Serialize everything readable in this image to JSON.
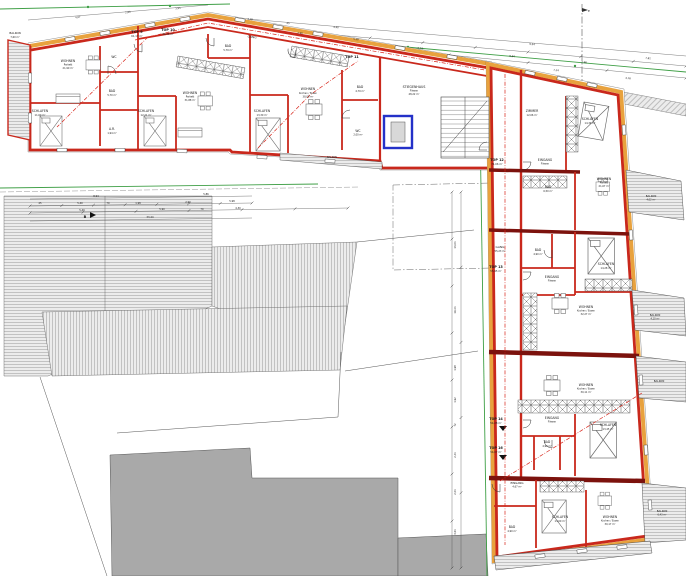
{
  "colors": {
    "wall_red": "#c9281c",
    "wall_dark": "#7c120d",
    "insulation_orange": "#e8a23e",
    "elevator_blue": "#2431c8",
    "boundary_green": "#3f9f46",
    "escape_red": "#d8251a",
    "roof_fill": "#ececec",
    "hatch_line": "#8f8f8f",
    "terrain_gray": "#a9a9a9",
    "drawing_line": "#2b2b2b"
  },
  "labels": {
    "units": [
      {
        "n": "unit-top9",
        "t": "TOP 9",
        "x": 137,
        "y": 33,
        "s": 3.4,
        "b": 1
      },
      {
        "n": "unit-top9-area",
        "t": "61,17 m²",
        "x": 137,
        "y": 37,
        "s": 2.5
      },
      {
        "n": "unit-top10",
        "t": "TOP 10",
        "x": 168,
        "y": 31,
        "s": 3.4,
        "b": 1
      },
      {
        "n": "unit-top10-area",
        "t": "56,36 m²",
        "x": 168,
        "y": 35,
        "s": 2.5
      },
      {
        "n": "unit-top11",
        "t": "TOP 11",
        "x": 352,
        "y": 58,
        "s": 3.4,
        "b": 1
      },
      {
        "n": "unit-top12",
        "t": "TOP 12",
        "x": 497,
        "y": 161,
        "s": 3.4,
        "b": 1
      },
      {
        "n": "unit-top12-area",
        "t": "71,06 m²",
        "x": 497,
        "y": 165,
        "s": 2.5
      },
      {
        "n": "unit-top13",
        "t": "TOP 13",
        "x": 496,
        "y": 268,
        "s": 3.4,
        "b": 1
      },
      {
        "n": "unit-top13-area",
        "t": "55,95 m²",
        "x": 496,
        "y": 272,
        "s": 2.5
      },
      {
        "n": "unit-top14",
        "t": "TOP 14",
        "x": 496,
        "y": 420,
        "s": 3.4,
        "b": 1
      },
      {
        "n": "unit-top14-area",
        "t": "54,28 m²",
        "x": 496,
        "y": 424,
        "s": 2.5
      },
      {
        "n": "unit-top16",
        "t": "TOP 16",
        "x": 496,
        "y": 449,
        "s": 3.4,
        "b": 1
      },
      {
        "n": "unit-top16-area",
        "t": "54,07 m²",
        "x": 496,
        "y": 453,
        "s": 2.5
      }
    ],
    "rooms": [
      {
        "n": "room-balkon-nw",
        "t": "BALKON",
        "x": 15,
        "y": 34,
        "s": 2.8
      },
      {
        "n": "room-balkon-nw-area",
        "t": "7,60 m²",
        "x": 15,
        "y": 38,
        "s": 2.4
      },
      {
        "n": "room-wohnen-9",
        "t": "WOHNEN",
        "x": 68,
        "y": 62
      },
      {
        "n": "room-wohnen-9-floor",
        "t": "Parkett",
        "x": 68,
        "y": 65.5,
        "s": 2.4
      },
      {
        "n": "room-wohnen-9-area",
        "t": "21,90 m²",
        "x": 68,
        "y": 69,
        "s": 2.4
      },
      {
        "n": "room-schlafen-9",
        "t": "SCHLAFEN",
        "x": 40,
        "y": 112
      },
      {
        "n": "room-schlafen-9-area",
        "t": "11,60 m²",
        "x": 40,
        "y": 116,
        "s": 2.4
      },
      {
        "n": "room-wc-9",
        "t": "WC",
        "x": 114,
        "y": 58
      },
      {
        "n": "room-bad-9",
        "t": "BAD",
        "x": 112,
        "y": 92
      },
      {
        "n": "room-bad-9-area",
        "t": "5,70 m²",
        "x": 112,
        "y": 96,
        "s": 2.4
      },
      {
        "n": "room-ar-9",
        "t": "A.R.",
        "x": 112,
        "y": 130
      },
      {
        "n": "room-ar-9-area",
        "t": "1,94 m²",
        "x": 112,
        "y": 134,
        "s": 2.4
      },
      {
        "n": "room-schlafen-10",
        "t": "SCHLAFEN",
        "x": 146,
        "y": 112
      },
      {
        "n": "room-schlafen-10-area",
        "t": "12,21 m²",
        "x": 146,
        "y": 116,
        "s": 2.4
      },
      {
        "n": "room-wohnen-10",
        "t": "WOHNEN",
        "x": 190,
        "y": 94
      },
      {
        "n": "room-wohnen-10-floor",
        "t": "Parkett",
        "x": 190,
        "y": 97.5,
        "s": 2.4
      },
      {
        "n": "room-wohnen-10-area",
        "t": "31,88 m²",
        "x": 190,
        "y": 101,
        "s": 2.4
      },
      {
        "n": "room-bad-10",
        "t": "BAD",
        "x": 228,
        "y": 47
      },
      {
        "n": "room-bad-10-area",
        "t": "5,79 m²",
        "x": 228,
        "y": 51,
        "s": 2.4
      },
      {
        "n": "room-schlafen-11",
        "t": "SCHLAFEN",
        "x": 262,
        "y": 112
      },
      {
        "n": "room-schlafen-11-area",
        "t": "13,30 m²",
        "x": 262,
        "y": 116,
        "s": 2.4
      },
      {
        "n": "room-wohnen-11",
        "t": "WOHNEN",
        "x": 308,
        "y": 90
      },
      {
        "n": "room-wohnen-11-floor",
        "t": "Kochen / Essen",
        "x": 308,
        "y": 94,
        "s": 2.4
      },
      {
        "n": "room-wohnen-11-area",
        "t": "38,08 m²",
        "x": 308,
        "y": 97.5,
        "s": 2.4
      },
      {
        "n": "room-bad-11",
        "t": "BAD",
        "x": 360,
        "y": 88
      },
      {
        "n": "room-bad-11-area",
        "t": "4,79 m²",
        "x": 360,
        "y": 92,
        "s": 2.4
      },
      {
        "n": "room-wc-11",
        "t": "WC",
        "x": 358,
        "y": 132
      },
      {
        "n": "room-wc-11-area",
        "t": "2,00 m²",
        "x": 358,
        "y": 135.5,
        "s": 2.4
      },
      {
        "n": "room-stiegenhaus",
        "t": "STIEGENHAUS",
        "x": 414,
        "y": 88,
        "s": 3.2
      },
      {
        "n": "room-stiegenhaus-floor",
        "t": "Fliesen",
        "x": 414,
        "y": 91.5,
        "s": 2.4
      },
      {
        "n": "room-stiegenhaus-area",
        "t": "48,22 m²",
        "x": 414,
        "y": 95,
        "s": 2.4
      },
      {
        "n": "room-zimmer-12",
        "t": "ZIMMER",
        "x": 532,
        "y": 112
      },
      {
        "n": "room-zimmer-12-area",
        "t": "12,06 m²",
        "x": 532,
        "y": 116,
        "s": 2.4
      },
      {
        "n": "room-schlafen-12",
        "t": "SCHLAFEN",
        "x": 590,
        "y": 120
      },
      {
        "n": "room-schlafen-12-area",
        "t": "14,34 m²",
        "x": 590,
        "y": 124,
        "s": 2.4
      },
      {
        "n": "room-eingang-12",
        "t": "EINGANG",
        "x": 545,
        "y": 161
      },
      {
        "n": "room-eingang-12-floor",
        "t": "Fliesen",
        "x": 545,
        "y": 164.5,
        "s": 2.4
      },
      {
        "n": "room-bad-12",
        "t": "BAD",
        "x": 548,
        "y": 188
      },
      {
        "n": "room-bad-12-area",
        "t": "6,50 m²",
        "x": 548,
        "y": 192,
        "s": 2.4
      },
      {
        "n": "room-wohnen-12",
        "t": "WOHNEN",
        "x": 604,
        "y": 180
      },
      {
        "n": "room-wohnen-12-floor",
        "t": "Parkett",
        "x": 604,
        "y": 183.5,
        "s": 2.4
      },
      {
        "n": "room-wohnen-12-area",
        "t": "21,67 m²",
        "x": 604,
        "y": 187,
        "s": 2.4
      },
      {
        "n": "room-bad-13",
        "t": "BAD",
        "x": 538,
        "y": 251
      },
      {
        "n": "room-bad-13-area",
        "t": "4,90 m²",
        "x": 538,
        "y": 255,
        "s": 2.4
      },
      {
        "n": "room-eingang-13",
        "t": "EINGANG",
        "x": 552,
        "y": 278
      },
      {
        "n": "room-eingang-13-floor",
        "t": "Fliesen",
        "x": 552,
        "y": 281.5,
        "s": 2.4
      },
      {
        "n": "room-schlafen-13",
        "t": "SCHLAFEN",
        "x": 606,
        "y": 265
      },
      {
        "n": "room-schlafen-13-area",
        "t": "14,28 m²",
        "x": 606,
        "y": 269,
        "s": 2.4
      },
      {
        "n": "room-wohnen-13",
        "t": "WOHNEN",
        "x": 586,
        "y": 308
      },
      {
        "n": "room-wohnen-13-floor",
        "t": "Kochen / Essen",
        "x": 586,
        "y": 311.5,
        "s": 2.4
      },
      {
        "n": "room-wohnen-13-area",
        "t": "32,27 m²",
        "x": 586,
        "y": 315,
        "s": 2.4
      },
      {
        "n": "room-wohnen-14",
        "t": "WOHNEN",
        "x": 586,
        "y": 386
      },
      {
        "n": "room-wohnen-14-floor",
        "t": "Kochen / Essen",
        "x": 586,
        "y": 389.5,
        "s": 2.4
      },
      {
        "n": "room-wohnen-14-area",
        "t": "30,11 m²",
        "x": 586,
        "y": 393,
        "s": 2.4
      },
      {
        "n": "room-eingang-14",
        "t": "EINGANG",
        "x": 552,
        "y": 419
      },
      {
        "n": "room-eingang-14-floor",
        "t": "Fliesen",
        "x": 552,
        "y": 422.5,
        "s": 2.4
      },
      {
        "n": "room-bad-14",
        "t": "BAD",
        "x": 547,
        "y": 443
      },
      {
        "n": "room-bad-14-area",
        "t": "4,90 m²",
        "x": 547,
        "y": 447,
        "s": 2.4
      },
      {
        "n": "room-schlafen-14",
        "t": "SCHLAFEN",
        "x": 608,
        "y": 426
      },
      {
        "n": "room-schlafen-14-area",
        "t": "13,45 m²",
        "x": 608,
        "y": 430,
        "s": 2.4
      },
      {
        "n": "room-eingang-16",
        "t": "EINGANG",
        "x": 517,
        "y": 484,
        "s": 2.8
      },
      {
        "n": "room-eingang-16-area",
        "t": "4,67 m²",
        "x": 517,
        "y": 487.5,
        "s": 2.4
      },
      {
        "n": "room-bad-16",
        "t": "BAD",
        "x": 512,
        "y": 528
      },
      {
        "n": "room-bad-16-area",
        "t": "4,90 m²",
        "x": 512,
        "y": 532,
        "s": 2.4
      },
      {
        "n": "room-schlafen-16",
        "t": "SCHLAFEN",
        "x": 560,
        "y": 518
      },
      {
        "n": "room-schlafen-16-area",
        "t": "13,00 m²",
        "x": 560,
        "y": 522,
        "s": 2.4
      },
      {
        "n": "room-wohnen-16",
        "t": "WOHNEN",
        "x": 610,
        "y": 518
      },
      {
        "n": "room-wohnen-16-floor",
        "t": "Kochen / Essen",
        "x": 610,
        "y": 521.5,
        "s": 2.4
      },
      {
        "n": "room-wohnen-16-area",
        "t": "30,17 m²",
        "x": 610,
        "y": 525,
        "s": 2.4
      }
    ],
    "circulation": [
      {
        "n": "corridor-gang-top",
        "t": "GANG",
        "x": 252,
        "y": 38,
        "s": 3,
        "c": "#d8251a",
        "r": 6
      },
      {
        "n": "corridor-gang-west",
        "t": "GANG",
        "x": 500,
        "y": 248,
        "s": 3,
        "c": "#d8251a"
      },
      {
        "n": "corridor-gang-west-area",
        "t": "55,23 m²",
        "x": 500,
        "y": 252,
        "s": 2.4,
        "c": "#d8251a"
      }
    ],
    "balconies": [
      {
        "n": "balkon-12",
        "t": "BALKON",
        "x": 651,
        "y": 197,
        "s": 2.6
      },
      {
        "n": "balkon-12-area",
        "t": "4,02 m²",
        "x": 651,
        "y": 200.5,
        "s": 2.3
      },
      {
        "n": "balkon-13",
        "t": "BALKON",
        "x": 655,
        "y": 316,
        "s": 2.6
      },
      {
        "n": "balkon-13-area",
        "t": "4,10 m²",
        "x": 655,
        "y": 319.5,
        "s": 2.3
      },
      {
        "n": "balkon-14",
        "t": "BALKON",
        "x": 659,
        "y": 382,
        "s": 2.6
      },
      {
        "n": "balkon-16",
        "t": "BALKON",
        "x": 662,
        "y": 512,
        "s": 2.6
      },
      {
        "n": "balkon-16-area",
        "t": "6,43 m²",
        "x": 662,
        "y": 515.5,
        "s": 2.3
      },
      {
        "n": "balkon-top11",
        "t": "BALKON",
        "x": 332,
        "y": 158,
        "s": 2.4
      }
    ],
    "dimensions": [
      {
        "n": "dim",
        "t": "4,70",
        "x": 250,
        "y": 20,
        "r": 6
      },
      {
        "n": "dim",
        "t": "45",
        "x": 288,
        "y": 24,
        "r": 6
      },
      {
        "n": "dim",
        "t": "4,40",
        "x": 336,
        "y": 28,
        "r": 6
      },
      {
        "n": "dim",
        "t": "2,90",
        "x": 300,
        "y": 34,
        "r": 6
      },
      {
        "n": "dim",
        "t": "5,20",
        "x": 356,
        "y": 40,
        "r": 6
      },
      {
        "n": "dim",
        "t": "3,74",
        "x": 420,
        "y": 49,
        "r": 6
      },
      {
        "n": "dim",
        "t": "9,54",
        "x": 532,
        "y": 45,
        "r": 6
      },
      {
        "n": "dim",
        "t": "6,84",
        "x": 512,
        "y": 57,
        "r": 6
      },
      {
        "n": "dim",
        "t": "2,96",
        "x": 584,
        "y": 63,
        "r": 6
      },
      {
        "n": "dim",
        "t": "7,24",
        "x": 556,
        "y": 71,
        "r": 6
      },
      {
        "n": "dim",
        "t": "4,76",
        "x": 628,
        "y": 79,
        "r": 6
      },
      {
        "n": "dim",
        "t": "7,61",
        "x": 648,
        "y": 59,
        "r": 6
      },
      {
        "n": "dim",
        "t": "4,07",
        "x": 78,
        "y": 18,
        "r": -9
      },
      {
        "n": "dim",
        "t": "2,60",
        "x": 128,
        "y": 13,
        "r": -9
      },
      {
        "n": "dim",
        "t": "3,94",
        "x": 178,
        "y": 9,
        "r": -9
      },
      {
        "n": "dim",
        "t": "8,94",
        "x": 96,
        "y": 197
      },
      {
        "n": "dim",
        "t": "5,86",
        "x": 206,
        "y": 195
      },
      {
        "n": "dim",
        "t": "45",
        "x": 40,
        "y": 204
      },
      {
        "n": "dim",
        "t": "5,40",
        "x": 80,
        "y": 204
      },
      {
        "n": "dim",
        "t": "70",
        "x": 108,
        "y": 204
      },
      {
        "n": "dim",
        "t": "1,98",
        "x": 138,
        "y": 204
      },
      {
        "n": "dim",
        "t": "2,90",
        "x": 188,
        "y": 203
      },
      {
        "n": "dim",
        "t": "5,98",
        "x": 232,
        "y": 202
      },
      {
        "n": "dim",
        "t": "5,40",
        "x": 82,
        "y": 211
      },
      {
        "n": "dim",
        "t": "5,90",
        "x": 162,
        "y": 210
      },
      {
        "n": "dim",
        "t": "70",
        "x": 202,
        "y": 210
      },
      {
        "n": "dim",
        "t": "4,30",
        "x": 238,
        "y": 209
      },
      {
        "n": "dim",
        "t": "33,44",
        "x": 150,
        "y": 218
      },
      {
        "n": "dim",
        "t": "13,64",
        "x": 456,
        "y": 245,
        "r": -90
      },
      {
        "n": "dim",
        "t": "19,44",
        "x": 456,
        "y": 310,
        "r": -90
      },
      {
        "n": "dim",
        "t": "1,98",
        "x": 456,
        "y": 368,
        "r": -90
      },
      {
        "n": "dim",
        "t": "1,92",
        "x": 456,
        "y": 400,
        "r": -90
      },
      {
        "n": "dim",
        "t": "72",
        "x": 456,
        "y": 425,
        "r": -90
      },
      {
        "n": "dim",
        "t": "2,44",
        "x": 456,
        "y": 455,
        "r": -90
      },
      {
        "n": "dim",
        "t": "2,04",
        "x": 456,
        "y": 492,
        "r": -90
      },
      {
        "n": "dim",
        "t": "3,64",
        "x": 456,
        "y": 532,
        "r": -90
      }
    ],
    "markers": [
      {
        "n": "section-marker-b",
        "t": "B",
        "x": 85,
        "y": 218,
        "s": 3.5,
        "b": 1
      },
      {
        "n": "section-marker-e",
        "t": "E",
        "x": 589,
        "y": 12,
        "s": 3
      }
    ]
  }
}
